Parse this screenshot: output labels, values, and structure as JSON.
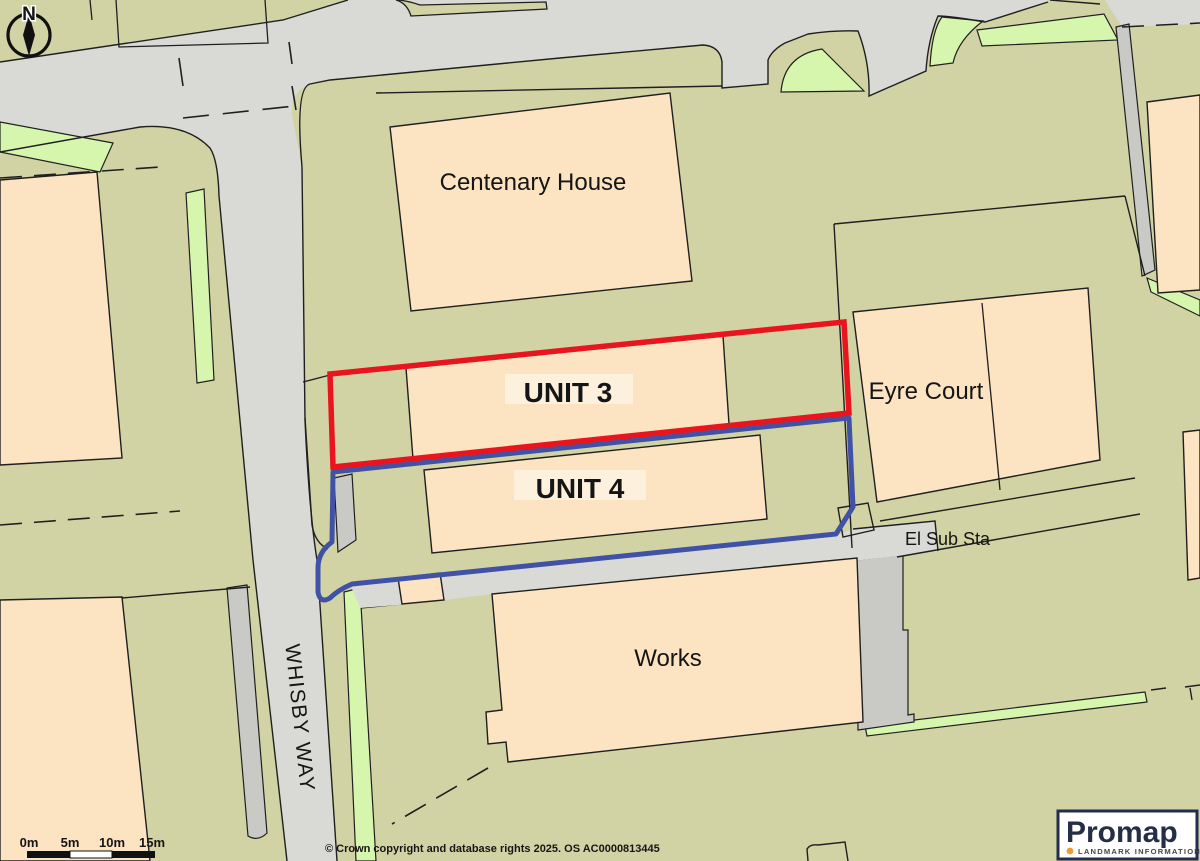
{
  "map": {
    "labels": {
      "centenary_house": "Centenary House",
      "unit_3": "UNIT 3",
      "unit_4": "UNIT 4",
      "eyre_court": "Eyre Court",
      "works": "Works",
      "el_sub_sta": "El Sub Sta",
      "whisby_way": "WHISBY WAY"
    },
    "boundaries": {
      "unit_3_outline_color": "#e8151e",
      "unit_4_outline_color": "#4152a6"
    },
    "compass": {
      "north": "N"
    },
    "scale_bar": {
      "labels": [
        "0m",
        "5m",
        "10m",
        "15m"
      ]
    },
    "attribution": "© Crown copyright and database rights 2025. OS AC0000813445",
    "logo": {
      "brand": "Promap",
      "tagline": "LANDMARK INFORMATION"
    }
  }
}
